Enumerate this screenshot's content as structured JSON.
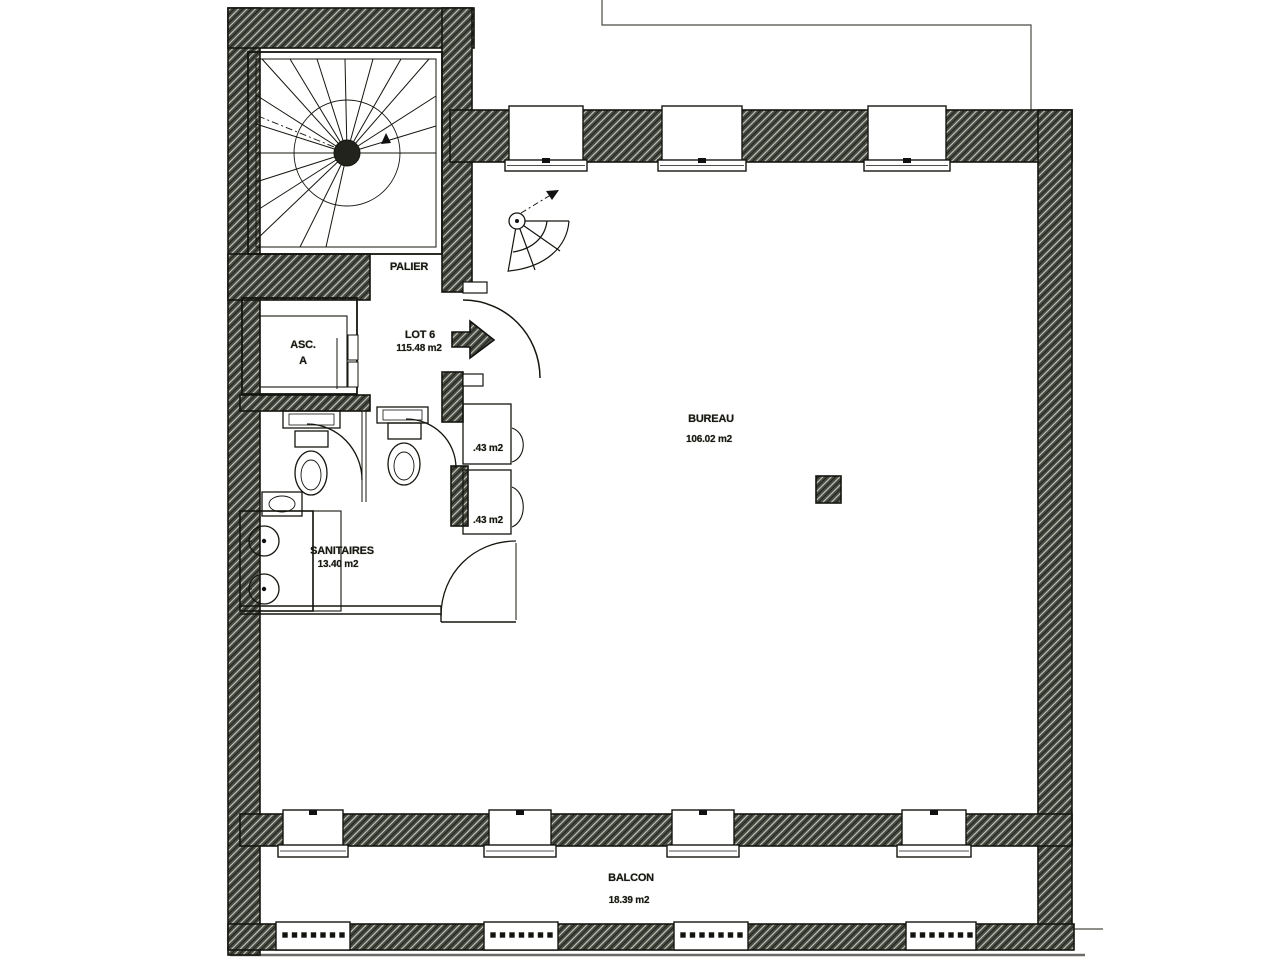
{
  "plan": {
    "type": "architectural floor plan (scanned)",
    "rooms": {
      "palier": {
        "name": "PALIER"
      },
      "ascenseur": {
        "name": "ASC.",
        "letter": "A"
      },
      "lot6": {
        "name": "LOT 6",
        "area": "115.48 m2"
      },
      "bureau": {
        "name": "BUREAU",
        "area": "106.02  m2"
      },
      "sanitaires": {
        "name": "SANITAIRES",
        "area": "13.40 m2"
      },
      "duct_top": {
        "area": ".43 m2"
      },
      "duct_bottom": {
        "area": ".43 m2"
      },
      "balcon": {
        "name": "BALCON",
        "area": "18.39  m2"
      }
    },
    "features": [
      "spiral-staircase",
      "service-spiral-stair",
      "elevator",
      "two-wc-stalls",
      "double-washbasin-counter",
      "entrance-arrow",
      "four-balcony-windows",
      "three-facade-windows",
      "balcony-balustrades",
      "masonry-column"
    ],
    "colors": {
      "paper": "#ffffff",
      "wall_fill": "#474b42",
      "wall_hatch_light": "#c8ccc0",
      "wall_hatch_dark": "#1f221c",
      "line": "#15150f"
    }
  }
}
